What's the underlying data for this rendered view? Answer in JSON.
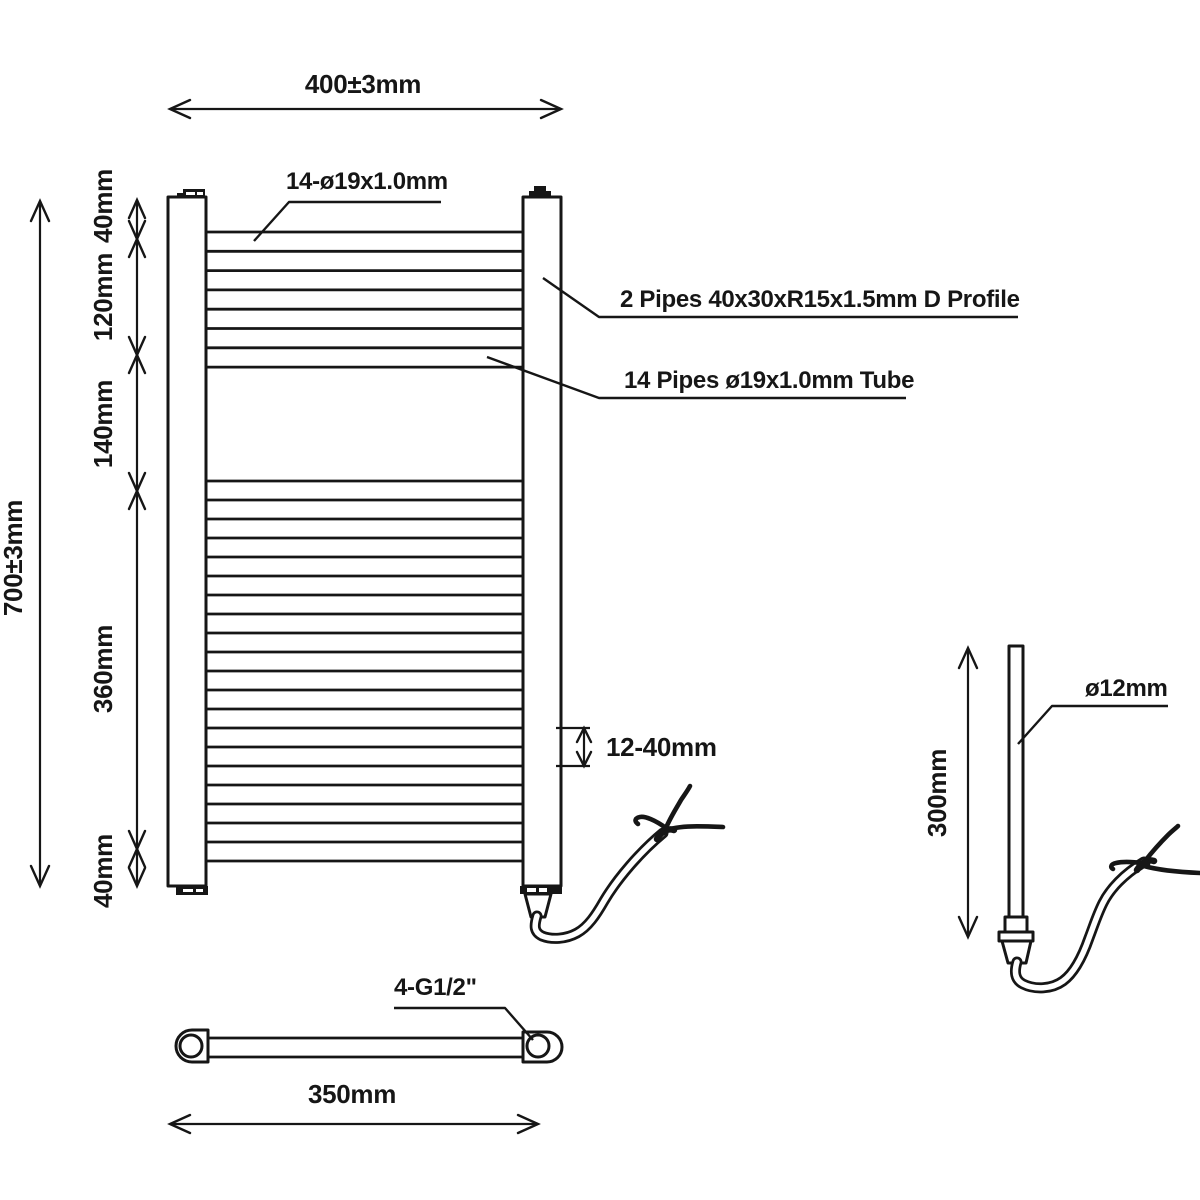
{
  "title": "Heated towel rail technical drawing",
  "colors": {
    "line": "#161616",
    "background": "#ffffff"
  },
  "front_view": {
    "width_dim": "400±3mm",
    "height_dim": "700±3mm",
    "segments": [
      "40mm",
      "120mm",
      "140mm",
      "360mm",
      "40mm"
    ],
    "top_pipes_label": "14-ø19x1.0mm",
    "d_profile_label": "2 Pipes 40x30xR15x1.5mm D Profile",
    "tube_label": "14 Pipes ø19x1.0mm Tube",
    "pipe_gap_dim": "12-40mm"
  },
  "bottom_view": {
    "centers_dim": "350mm",
    "thread_label": "4-G1/2\""
  },
  "element_view": {
    "length_dim": "300mm",
    "diameter_label": "ø12mm"
  },
  "drawing": {
    "pipe_line_groups": [
      {
        "x1": 206,
        "x2": 523,
        "y": 232,
        "spacing": 19.3,
        "count": 8
      },
      {
        "x1": 206,
        "x2": 523,
        "y": 481,
        "spacing": 19.0,
        "count": 21
      }
    ]
  }
}
